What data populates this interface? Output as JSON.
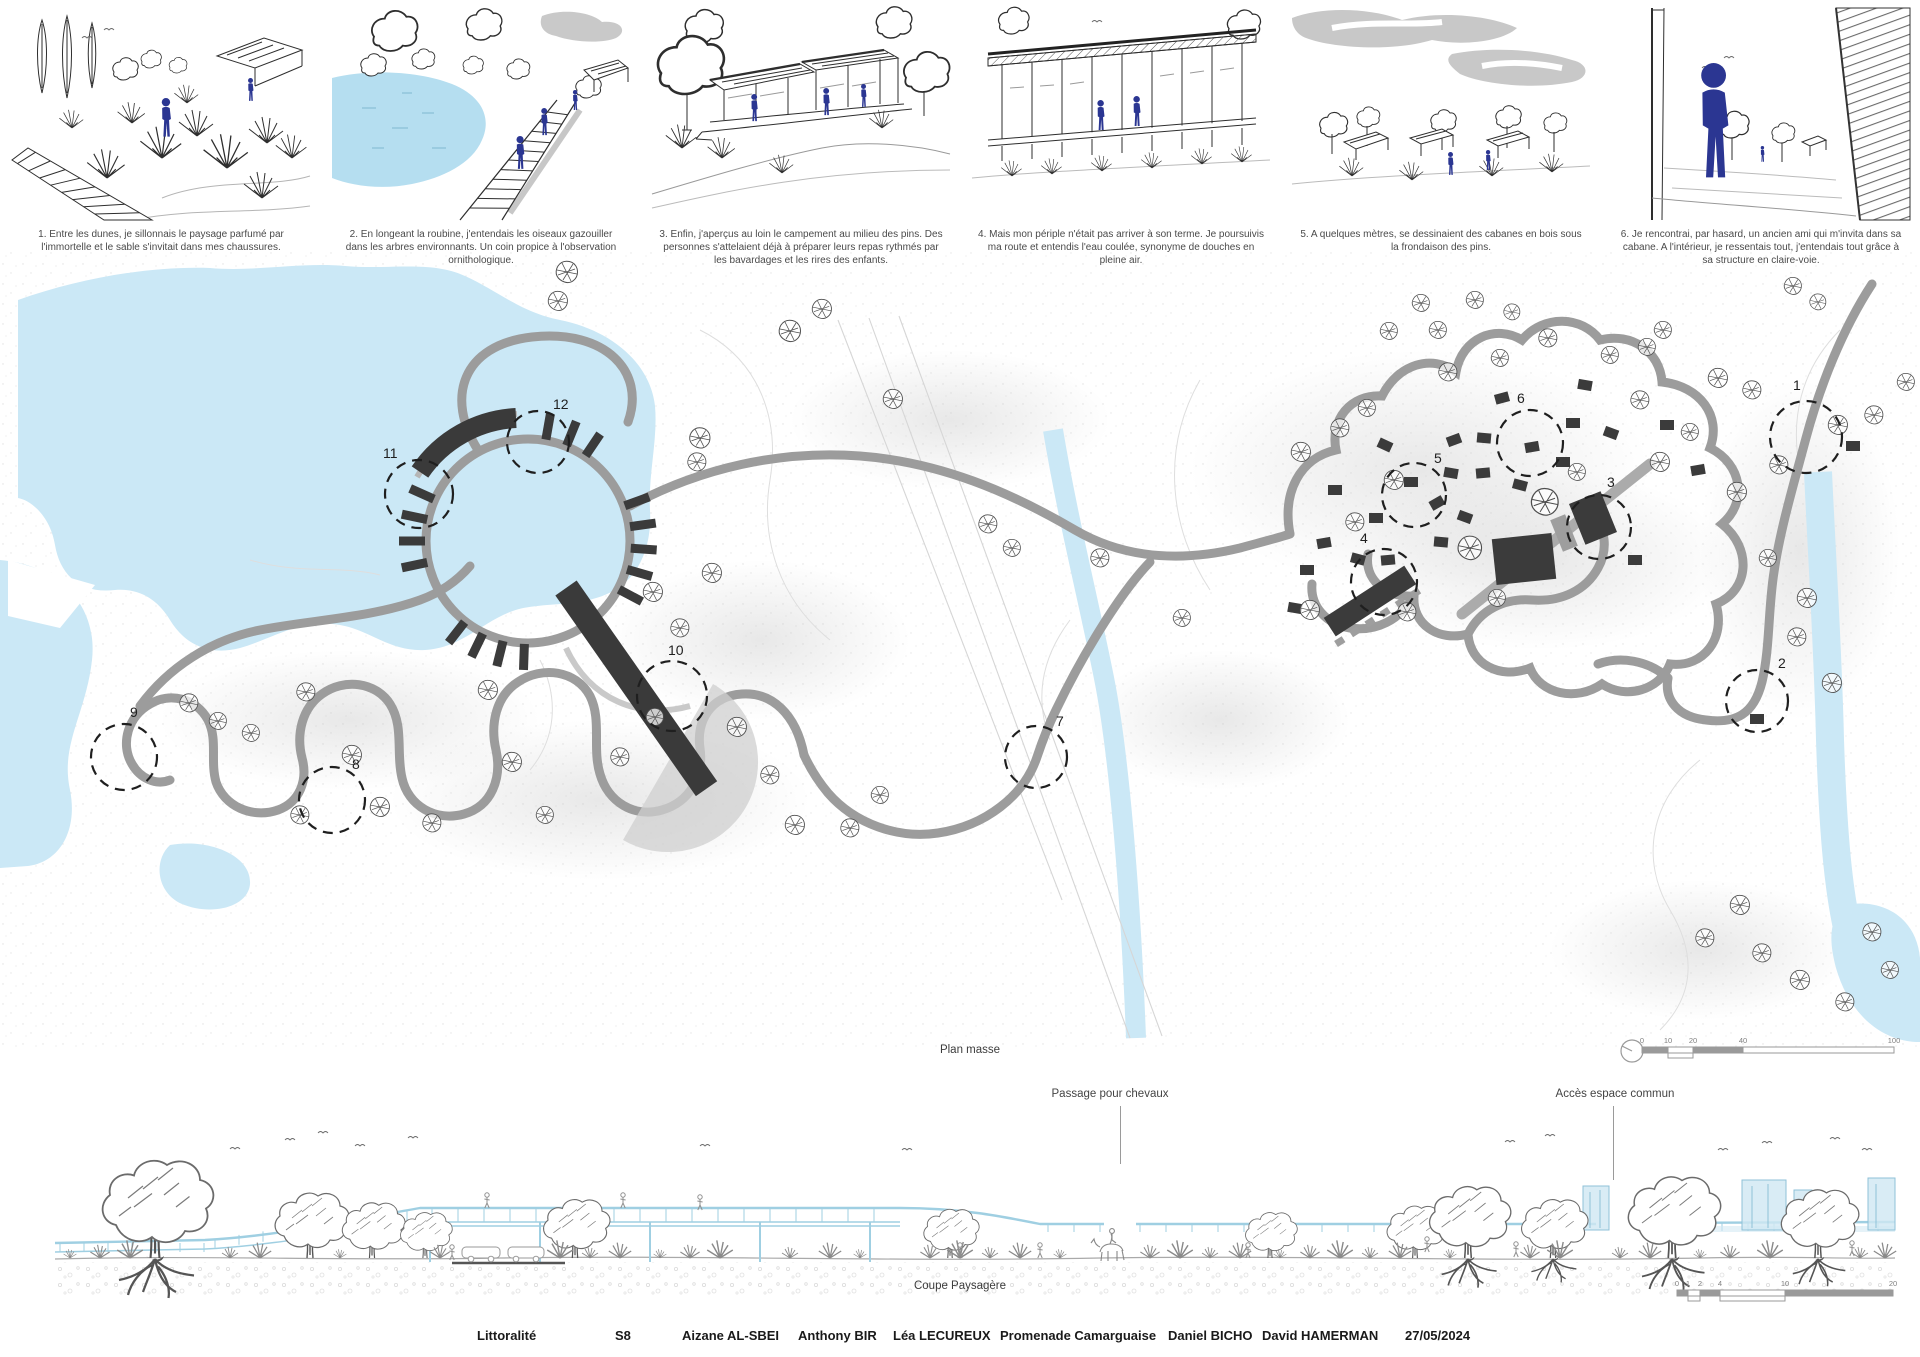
{
  "vignettes": [
    {
      "caption": "1.  Entre les dunes, je sillonnais le paysage parfumé par l'immortelle et le sable s'invitait dans mes chaussures."
    },
    {
      "caption": "2.  En longeant la roubine, j'entendais les oiseaux gazouiller dans les arbres environnants. Un coin propice à l'observation ornithologique."
    },
    {
      "caption": "3.  Enfin, j'aperçus au loin le campement au milieu des pins. Des personnes s'attelaient déjà à préparer leurs repas rythmés par les bavardages et les rires des enfants."
    },
    {
      "caption": "4.  Mais mon périple n'était pas arriver à son terme. Je poursuivis ma route et entendis l'eau coulée, synonyme de douches en pleine air."
    },
    {
      "caption": "5.  A quelques mètres, se dessinaient des cabanes en bois sous la frondaison des pins."
    },
    {
      "caption": "6.  Je rencontrai, par hasard, un ancien ami qui m'invita dans sa cabane. A l'intérieur, je ressentais tout, j'entendais tout grâce à sa structure en claire-voie."
    }
  ],
  "plan": {
    "label": "Plan masse",
    "markers": [
      {
        "n": "1",
        "x": 1806,
        "y": 437,
        "r": 36,
        "lx": 1793,
        "ly": 390
      },
      {
        "n": "2",
        "x": 1757,
        "y": 701,
        "r": 31,
        "lx": 1778,
        "ly": 668
      },
      {
        "n": "3",
        "x": 1599,
        "y": 527,
        "r": 32,
        "lx": 1607,
        "ly": 487
      },
      {
        "n": "4",
        "x": 1384,
        "y": 582,
        "r": 33,
        "lx": 1360,
        "ly": 543
      },
      {
        "n": "5",
        "x": 1414,
        "y": 495,
        "r": 32,
        "lx": 1434,
        "ly": 463
      },
      {
        "n": "6",
        "x": 1530,
        "y": 443,
        "r": 33,
        "lx": 1517,
        "ly": 403
      },
      {
        "n": "7",
        "x": 1036,
        "y": 757,
        "r": 31,
        "lx": 1056,
        "ly": 726
      },
      {
        "n": "8",
        "x": 332,
        "y": 800,
        "r": 33,
        "lx": 352,
        "ly": 769
      },
      {
        "n": "9",
        "x": 124,
        "y": 757,
        "r": 33,
        "lx": 130,
        "ly": 717
      },
      {
        "n": "10",
        "x": 672,
        "y": 696,
        "r": 35,
        "lx": 668,
        "ly": 655
      },
      {
        "n": "11",
        "x": 419,
        "y": 494,
        "r": 34,
        "lx": 383,
        "ly": 458
      },
      {
        "n": "12",
        "x": 538,
        "y": 442,
        "r": 31,
        "lx": 553,
        "ly": 409
      }
    ],
    "scalebar": {
      "ticks": [
        "0",
        "10",
        "20",
        "40",
        "100"
      ]
    },
    "trees": [
      [
        567,
        272,
        1
      ],
      [
        558,
        301,
        0.9
      ],
      [
        790,
        331,
        1
      ],
      [
        822,
        309,
        0.9
      ],
      [
        893,
        399,
        0.9
      ],
      [
        700,
        438,
        0.95
      ],
      [
        697,
        462,
        0.85
      ],
      [
        653,
        592,
        0.9
      ],
      [
        712,
        573,
        0.9
      ],
      [
        680,
        628,
        0.85
      ],
      [
        189,
        703,
        0.85
      ],
      [
        218,
        721,
        0.8
      ],
      [
        251,
        733,
        0.8
      ],
      [
        306,
        692,
        0.85
      ],
      [
        352,
        755,
        0.9
      ],
      [
        300,
        815,
        0.85
      ],
      [
        380,
        807,
        0.9
      ],
      [
        432,
        823,
        0.85
      ],
      [
        488,
        690,
        0.9
      ],
      [
        512,
        762,
        0.9
      ],
      [
        545,
        815,
        0.8
      ],
      [
        620,
        757,
        0.85
      ],
      [
        655,
        717,
        0.8
      ],
      [
        737,
        727,
        0.9
      ],
      [
        770,
        775,
        0.85
      ],
      [
        795,
        825,
        0.9
      ],
      [
        850,
        828,
        0.85
      ],
      [
        880,
        795,
        0.8
      ],
      [
        988,
        524,
        0.85
      ],
      [
        1012,
        548,
        0.8
      ],
      [
        1100,
        558,
        0.85
      ],
      [
        1182,
        618,
        0.8
      ],
      [
        1301,
        452,
        0.9
      ],
      [
        1340,
        428,
        0.85
      ],
      [
        1367,
        408,
        0.8
      ],
      [
        1448,
        372,
        0.85
      ],
      [
        1500,
        358,
        0.8
      ],
      [
        1548,
        338,
        0.85
      ],
      [
        1610,
        355,
        0.8
      ],
      [
        1647,
        347,
        0.8
      ],
      [
        1394,
        480,
        0.9
      ],
      [
        1355,
        522,
        0.85
      ],
      [
        1310,
        610,
        0.9
      ],
      [
        1407,
        612,
        0.85
      ],
      [
        1497,
        598,
        0.8
      ],
      [
        1545,
        502,
        1.25
      ],
      [
        1640,
        400,
        0.85
      ],
      [
        1660,
        462,
        0.9
      ],
      [
        1690,
        432,
        0.8
      ],
      [
        1577,
        472,
        0.8
      ],
      [
        1470,
        548,
        1.1
      ],
      [
        1438,
        330,
        0.8
      ],
      [
        1475,
        300,
        0.8
      ],
      [
        1512,
        312,
        0.75
      ],
      [
        1663,
        330,
        0.8
      ],
      [
        1389,
        331,
        0.8
      ],
      [
        1421,
        303,
        0.8
      ],
      [
        1793,
        286,
        0.8
      ],
      [
        1818,
        302,
        0.75
      ],
      [
        1718,
        378,
        0.9
      ],
      [
        1752,
        390,
        0.85
      ],
      [
        1838,
        425,
        0.9
      ],
      [
        1874,
        415,
        0.85
      ],
      [
        1906,
        382,
        0.8
      ],
      [
        1737,
        492,
        0.9
      ],
      [
        1779,
        465,
        0.85
      ],
      [
        1807,
        598,
        0.9
      ],
      [
        1797,
        637,
        0.85
      ],
      [
        1832,
        683,
        0.9
      ],
      [
        1768,
        558,
        0.8
      ],
      [
        1740,
        905,
        0.9
      ],
      [
        1705,
        938,
        0.85
      ],
      [
        1762,
        953,
        0.85
      ],
      [
        1800,
        980,
        0.9
      ],
      [
        1845,
        1002,
        0.85
      ],
      [
        1872,
        932,
        0.85
      ],
      [
        1890,
        970,
        0.8
      ]
    ],
    "cabins": [
      [
        1502,
        398,
        -15
      ],
      [
        1585,
        385,
        10
      ],
      [
        1573,
        423,
        0
      ],
      [
        1611,
        433,
        20
      ],
      [
        1532,
        447,
        -10
      ],
      [
        1563,
        462,
        0
      ],
      [
        1520,
        485,
        15
      ],
      [
        1454,
        440,
        -20
      ],
      [
        1484,
        438,
        5
      ],
      [
        1411,
        482,
        0
      ],
      [
        1437,
        503,
        -30
      ],
      [
        1451,
        473,
        10
      ],
      [
        1483,
        473,
        -5
      ],
      [
        1465,
        517,
        20
      ],
      [
        1376,
        518,
        0
      ],
      [
        1324,
        543,
        -10
      ],
      [
        1441,
        542,
        5
      ],
      [
        1358,
        559,
        15
      ],
      [
        1388,
        560,
        -5
      ],
      [
        1307,
        570,
        0
      ],
      [
        1295,
        608,
        10
      ],
      [
        1667,
        425,
        0
      ],
      [
        1853,
        446,
        0
      ],
      [
        1757,
        719,
        0
      ],
      [
        1635,
        560,
        0
      ],
      [
        1698,
        470,
        -10
      ],
      [
        1385,
        445,
        25
      ],
      [
        1335,
        490,
        0
      ]
    ]
  },
  "section": {
    "label": "Coupe Paysagère",
    "annotations": [
      {
        "text": "Passage pour chevaux"
      },
      {
        "text": "Accès espace commun"
      }
    ],
    "scalebar": {
      "ticks": [
        "0",
        "1",
        "2",
        "4",
        "10",
        "20"
      ]
    }
  },
  "footer": {
    "items": [
      {
        "t": "Littoralité",
        "x": 477
      },
      {
        "t": "S8",
        "x": 615
      },
      {
        "t": "Aizane AL-SBEI",
        "x": 682
      },
      {
        "t": "Anthony BIR",
        "x": 798
      },
      {
        "t": "Léa LECUREUX",
        "x": 893
      },
      {
        "t": "Promenade Camarguaise",
        "x": 1000
      },
      {
        "t": "Daniel BICHO",
        "x": 1168
      },
      {
        "t": "David HAMERMAN",
        "x": 1262
      },
      {
        "t": "27/05/2024",
        "x": 1405
      }
    ]
  },
  "colors": {
    "water": "#cbe8f6",
    "vignette_water": "#b5def0",
    "figure_navy": "#2b3692",
    "path_gray": "#9c9c9c",
    "structure_dark": "#3b3b3b",
    "cloud_gray": "#c8c8c8",
    "section_blue": "#9fcfe2"
  }
}
